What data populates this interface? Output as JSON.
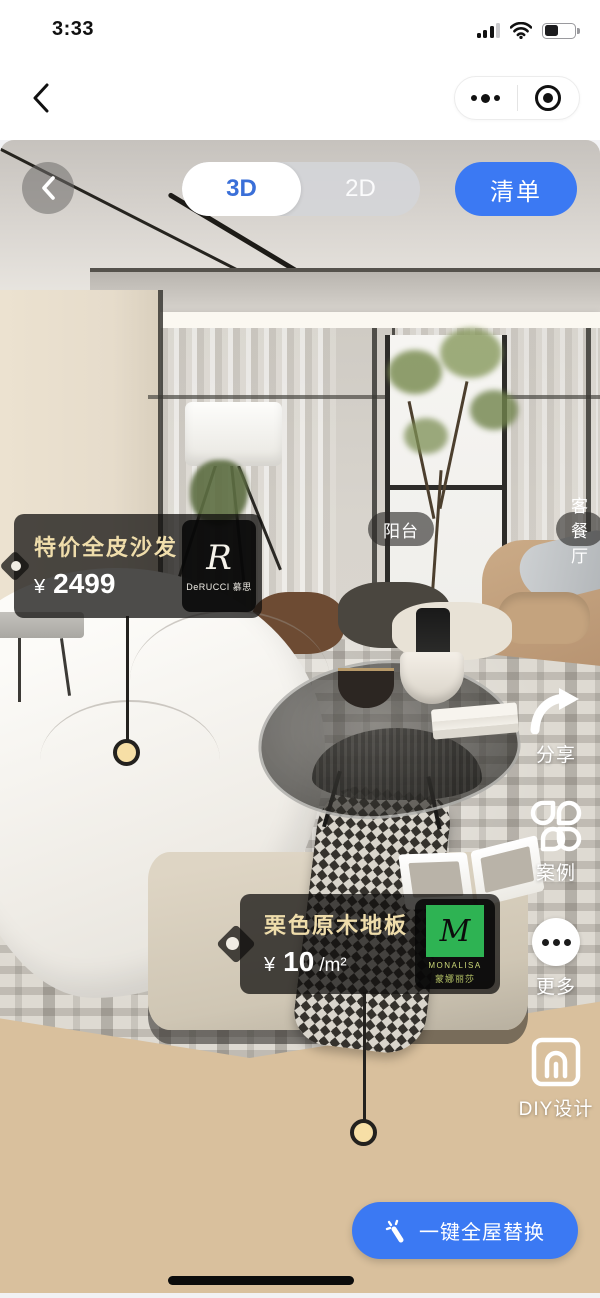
{
  "status_bar": {
    "time": "3:33"
  },
  "viewer": {
    "segmented": {
      "option_3d": "3D",
      "option_2d": "2D",
      "selected": "3D"
    },
    "list_button_label": "清单",
    "room_labels": {
      "balcony": "阳台",
      "living_dining": "客餐厅"
    },
    "sofa_tag": {
      "title": "特价全皮沙发",
      "price_symbol": "¥",
      "price_value": "2499",
      "brand_monogram": "R",
      "brand_name": "DeRUCCI 慕思"
    },
    "floor_tag": {
      "title": "栗色原木地板",
      "price_symbol": "¥",
      "price_value": "10",
      "price_unit": "/m²",
      "brand_monogram": "M",
      "brand_name": "MONALISA",
      "brand_name_cn": "蒙娜丽莎"
    },
    "side_actions": [
      {
        "label": "分享",
        "icon": "share-arrow"
      },
      {
        "label": "案例",
        "icon": "clover-grid"
      },
      {
        "label": "更多",
        "icon": "ellipsis-circle"
      },
      {
        "label": "DIY设计",
        "icon": "diy-frame"
      }
    ],
    "replace_button_label": "一键全屋替换"
  },
  "colors": {
    "accent_blue": "#3B79F3",
    "seg_selected_text": "#3A6FD8",
    "tag_background": "rgba(16,15,14,0.74)",
    "tag_title_gold": "#EFDDAB",
    "anchor_dot": "#F7DFA6",
    "brand_green": "#2EB353"
  }
}
